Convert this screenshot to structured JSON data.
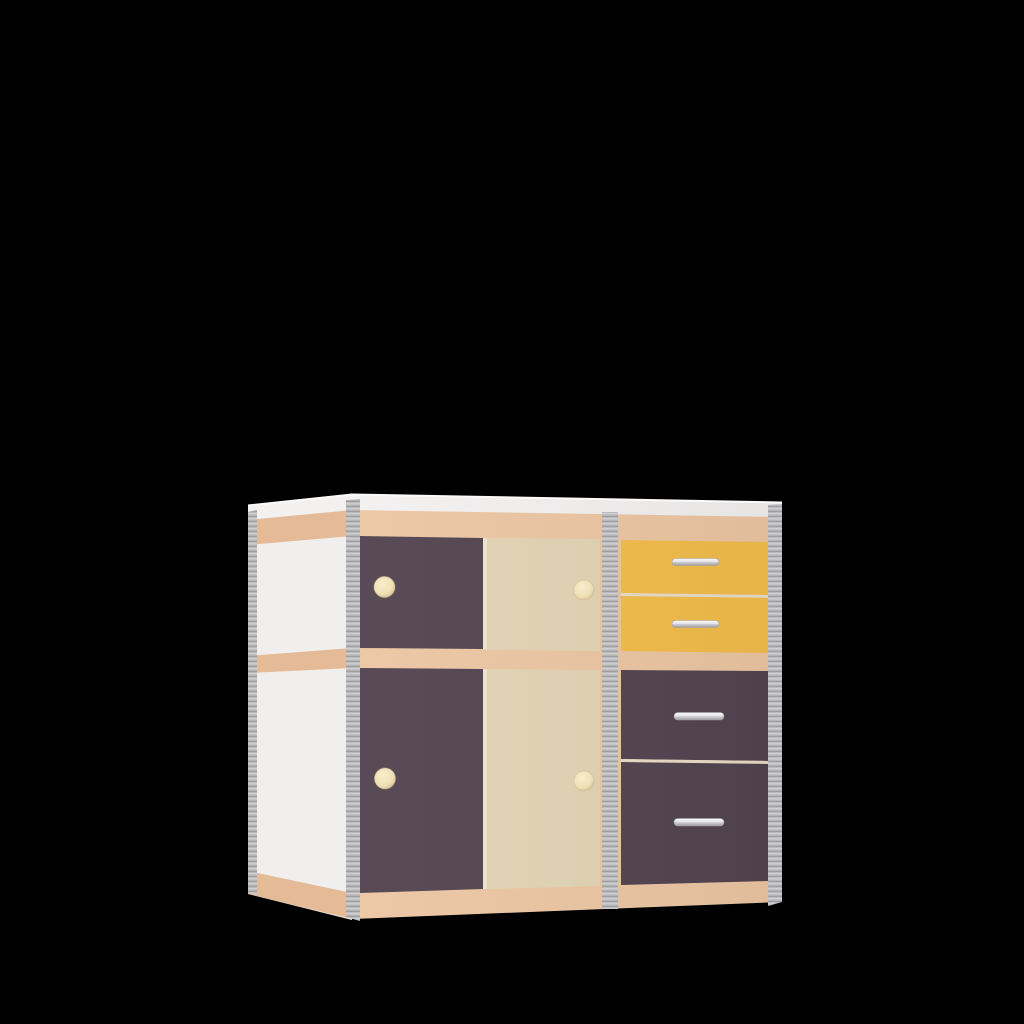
{
  "scene": {
    "background": "#000000",
    "object": "3D product render of a children's storage cabinet",
    "view": "three-quarter view from front-left, black backdrop"
  },
  "cabinet": {
    "colors": {
      "top_edge_white": "#f3f1f0",
      "top_surface_highlight": "#fbfaf9",
      "side_white": "#f1efee",
      "wood_front": "#ecc6a3",
      "wood_side": "#e5bb97",
      "plum_dark": "#524450",
      "cream_door": "#e2d4b4",
      "yellow_drawer": "#f2bd4a",
      "edge_gray_base": "#bcbcbe",
      "edge_gray_light": "#d3d3d5",
      "edge_gray_dark": "#97979b",
      "gap_light": "#eee4d1",
      "drawer_gap_line": "#e9ddc6",
      "knob_highlight": "#f8eecd",
      "knob_cream": "#eedfb4",
      "knob_shadow": "#c9b184",
      "handle_top": "#fafafc",
      "handle_mid": "#e7e7ea",
      "handle_low": "#c6c6ca",
      "handle_bottom": "#a09fa4"
    },
    "parts": {
      "side_panel": {
        "name": "left side panel",
        "color_name": "white"
      },
      "top_panel": {
        "name": "top panel with white edge",
        "color_name": "white"
      },
      "rails": {
        "name": "horizontal rails (top, middle, bottom)",
        "color_name": "beech wood"
      },
      "edge_banding": {
        "name": "vertical edge banding strips",
        "color_name": "gray plywood"
      },
      "doors": [
        {
          "name": "upper left door",
          "color_name": "dark plum",
          "hardware": "round cream knob"
        },
        {
          "name": "upper right door",
          "color_name": "cream",
          "hardware": "round cream knob"
        },
        {
          "name": "lower left door",
          "color_name": "dark plum",
          "hardware": "round cream knob"
        },
        {
          "name": "lower right door",
          "color_name": "cream",
          "hardware": "round cream knob"
        }
      ],
      "drawers": [
        {
          "name": "drawer 1 (top)",
          "color_name": "yellow",
          "hardware": "silver bar handle"
        },
        {
          "name": "drawer 2",
          "color_name": "yellow",
          "hardware": "silver bar handle"
        },
        {
          "name": "drawer 3",
          "color_name": "dark plum",
          "hardware": "silver bar handle"
        },
        {
          "name": "drawer 4 (bottom)",
          "color_name": "dark plum",
          "hardware": "silver bar handle"
        }
      ]
    }
  }
}
